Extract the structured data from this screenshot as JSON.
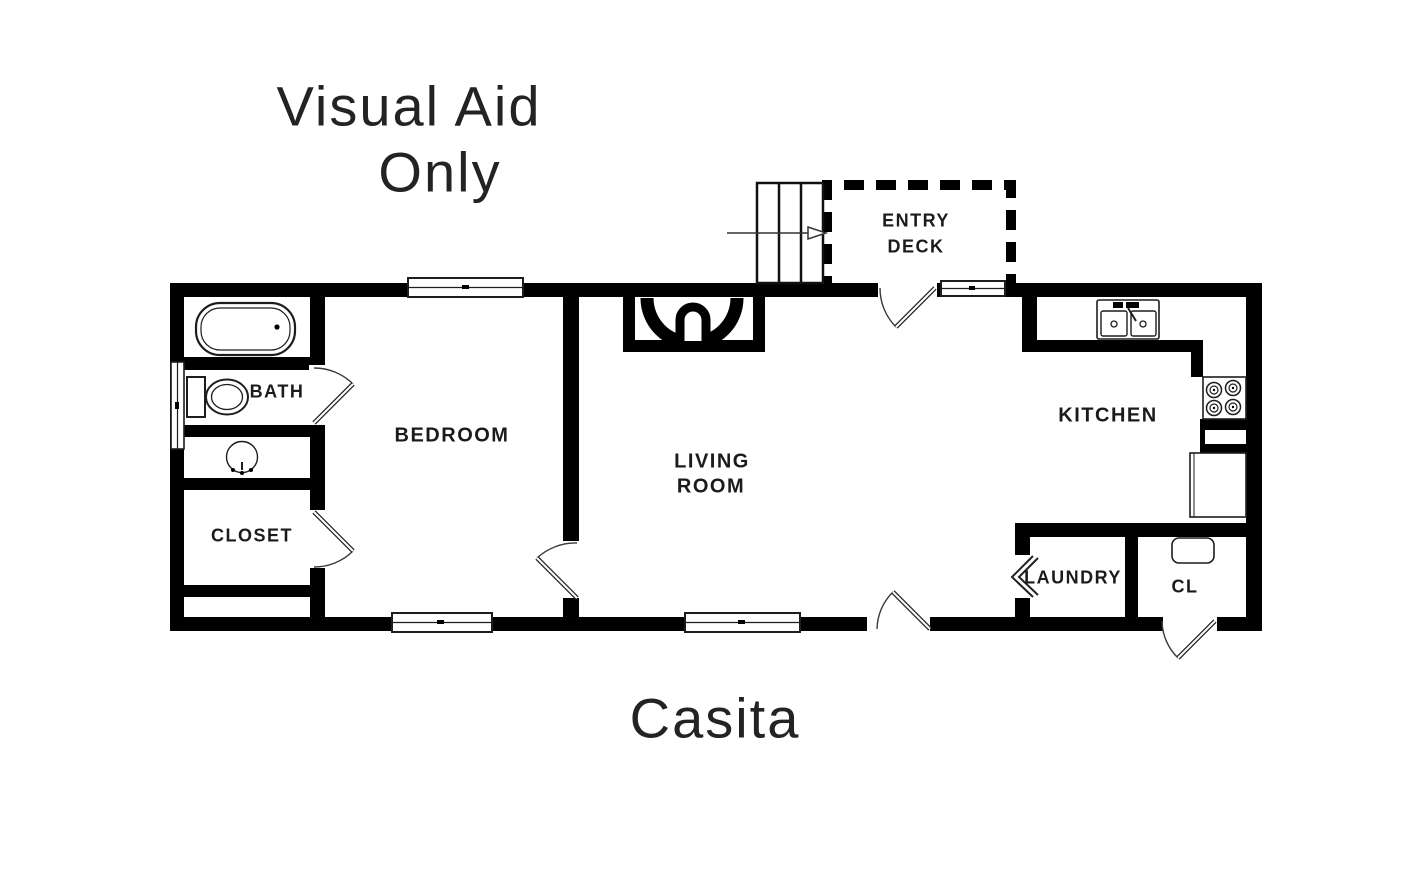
{
  "watermark": {
    "line1": "Visual Aid",
    "line2": "Only"
  },
  "plan_title": "Casita",
  "rooms": {
    "bath": "BATH",
    "bedroom": "BEDROOM",
    "closet": "CLOSET",
    "living_line1": "LIVING",
    "living_line2": "ROOM",
    "kitchen": "KITCHEN",
    "laundry": "LAUNDRY",
    "cl": "CL",
    "entry_line1": "ENTRY",
    "entry_line2": "DECK"
  },
  "fixtures": [
    "bathtub",
    "toilet",
    "bath-sink",
    "kitchen-double-sink",
    "cooktop-burners",
    "refrigerator",
    "fireplace",
    "stairs",
    "entry-arrow",
    "closet-shelf",
    "laundry-bifold-door",
    "window",
    "door-swing"
  ],
  "colors": {
    "wall": "#000000",
    "background": "#ffffff",
    "text": "#1b1b1b",
    "fixture_stroke": "#2a2a2a"
  }
}
